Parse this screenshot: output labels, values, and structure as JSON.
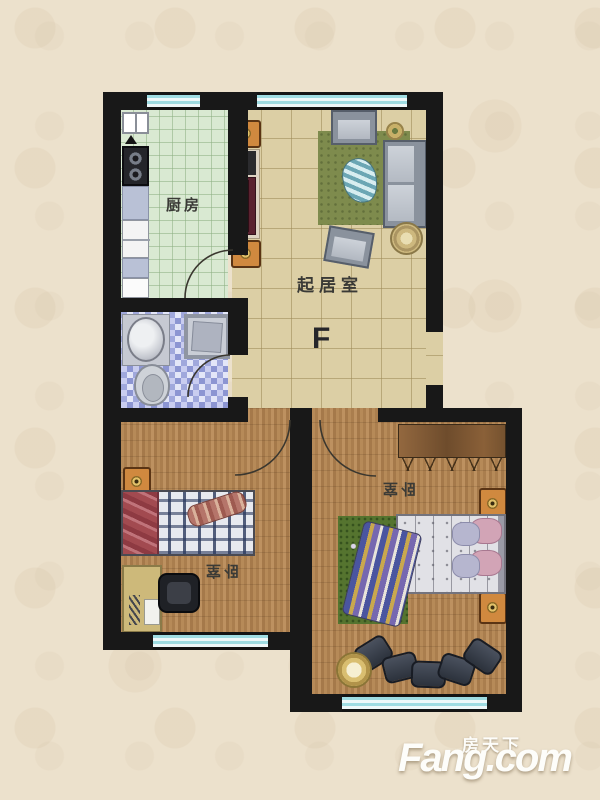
{
  "floorplan": {
    "unit_mark": "F",
    "rooms": {
      "kitchen": {
        "label": "厨房"
      },
      "living": {
        "label": "起居室"
      },
      "bedroom_left": {
        "label": "卧室"
      },
      "bedroom_right": {
        "label": "卧室"
      }
    },
    "colors": {
      "wall": "#181818",
      "kitchen_floor": "#d9e9d2",
      "living_floor": "#dccfa5",
      "bathroom_tile": "#9aa3d8",
      "bedroom_wood_floor": "#ad8355",
      "window_glass": "#a9dde2",
      "cabinet_accent": "#d0893f",
      "rug_green": "#7e8b4d",
      "page_background": "#ece1cc"
    }
  },
  "watermark": {
    "brand_cn": "房天下",
    "brand_en": "Fang.com"
  }
}
